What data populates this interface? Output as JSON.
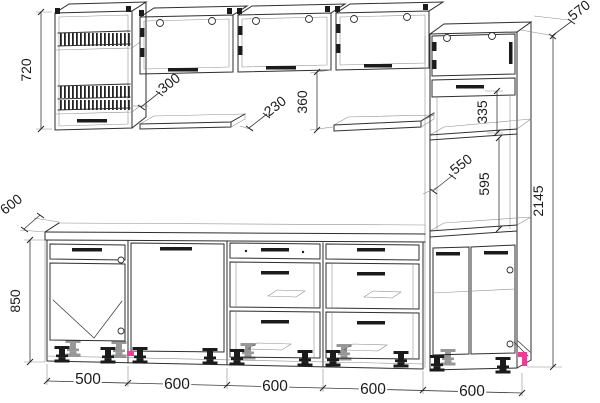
{
  "drawing": {
    "kind": "kitchen-set-dimension-drawing",
    "colors": {
      "line": "#2e2e2e",
      "accent": "#ef3d96",
      "background": "#ffffff"
    }
  },
  "dims": {
    "wall_cabinet_height": "720",
    "wall_gap": "300",
    "shelf_depth": "230",
    "shelf_drop": "360",
    "tall_upper": "335",
    "tall_depth": "570",
    "tall_side": "550",
    "tall_mid": "595",
    "total_height": "2145",
    "counter_depth": "600",
    "base_height": "850",
    "widths": [
      "500",
      "600",
      "600",
      "600",
      "600"
    ]
  }
}
